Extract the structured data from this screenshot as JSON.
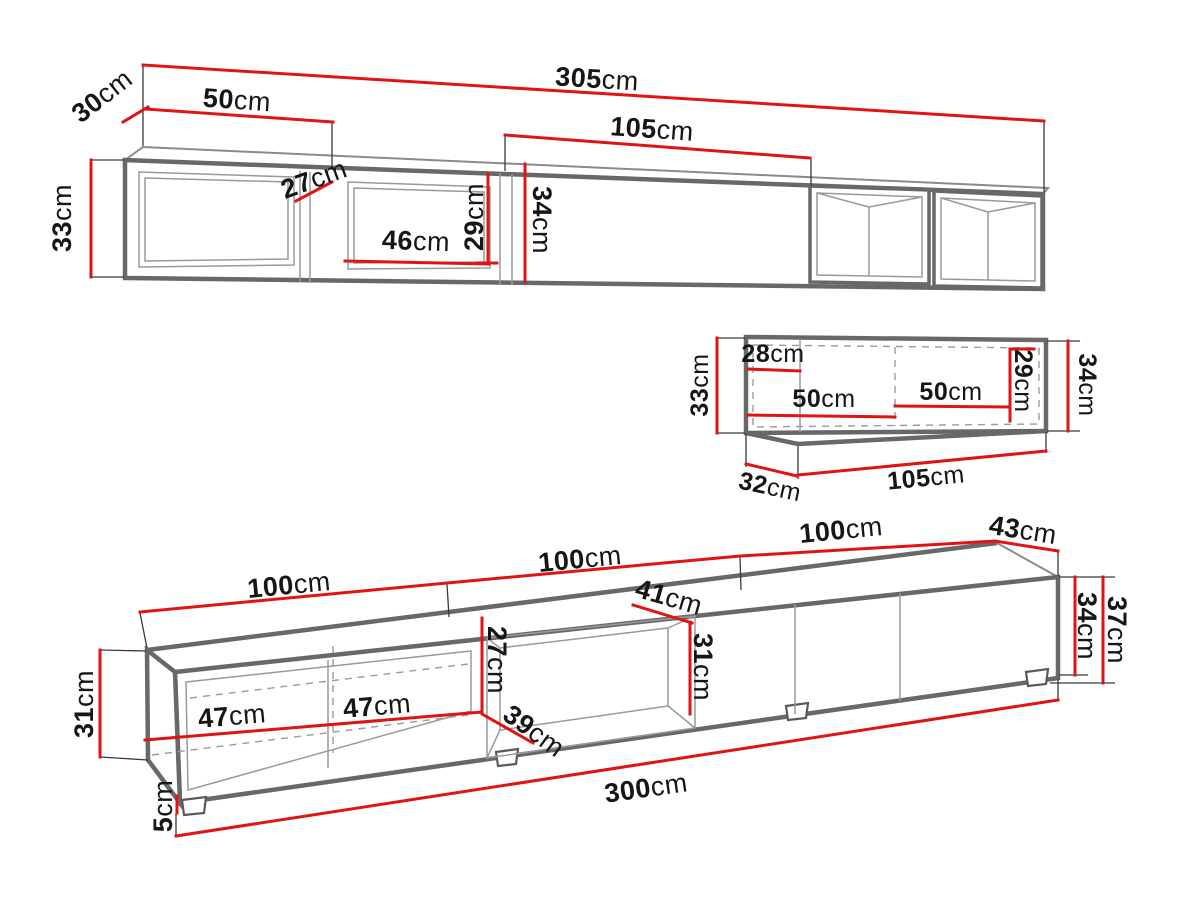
{
  "page": {
    "background": "#ffffff",
    "dimension_color": "#e11415",
    "outline_color": "#686868",
    "text_color": "#161616"
  },
  "diagram": {
    "wall_shelf": {
      "total_width": {
        "v": "305",
        "u": "cm"
      },
      "depth": {
        "v": "30",
        "u": "cm"
      },
      "left_section_width": {
        "v": "50",
        "u": "cm"
      },
      "divider_depth": {
        "v": "27",
        "u": "cm"
      },
      "niche_width": {
        "v": "46",
        "u": "cm"
      },
      "niche_height": {
        "v": "29",
        "u": "cm"
      },
      "mid_section_width": {
        "v": "105",
        "u": "cm"
      },
      "front_height": {
        "v": "34",
        "u": "cm"
      },
      "left_height": {
        "v": "33",
        "u": "cm"
      }
    },
    "small_shelf": {
      "left_inner_width": {
        "v": "28",
        "u": "cm"
      },
      "inner_width_left": {
        "v": "50",
        "u": "cm"
      },
      "inner_width_right": {
        "v": "50",
        "u": "cm"
      },
      "inner_height": {
        "v": "29",
        "u": "cm"
      },
      "left_height": {
        "v": "33",
        "u": "cm"
      },
      "right_height": {
        "v": "34",
        "u": "cm"
      },
      "depth": {
        "v": "32",
        "u": "cm"
      },
      "width": {
        "v": "105",
        "u": "cm"
      }
    },
    "tv_stand": {
      "section1_width": {
        "v": "100",
        "u": "cm"
      },
      "section2_width": {
        "v": "100",
        "u": "cm"
      },
      "section3_width": {
        "v": "100",
        "u": "cm"
      },
      "top_depth": {
        "v": "43",
        "u": "cm"
      },
      "niche_top_depth": {
        "v": "41",
        "u": "cm"
      },
      "inner_width_1": {
        "v": "47",
        "u": "cm"
      },
      "inner_width_2": {
        "v": "47",
        "u": "cm"
      },
      "niche_front_height": {
        "v": "27",
        "u": "cm"
      },
      "niche_bottom_depth": {
        "v": "39",
        "u": "cm"
      },
      "niche_back_height": {
        "v": "31",
        "u": "cm"
      },
      "left_height": {
        "v": "31",
        "u": "cm"
      },
      "foot_height": {
        "v": "5",
        "u": "cm"
      },
      "body_height": {
        "v": "34",
        "u": "cm"
      },
      "total_height": {
        "v": "37",
        "u": "cm"
      },
      "total_width": {
        "v": "300",
        "u": "cm"
      }
    }
  }
}
